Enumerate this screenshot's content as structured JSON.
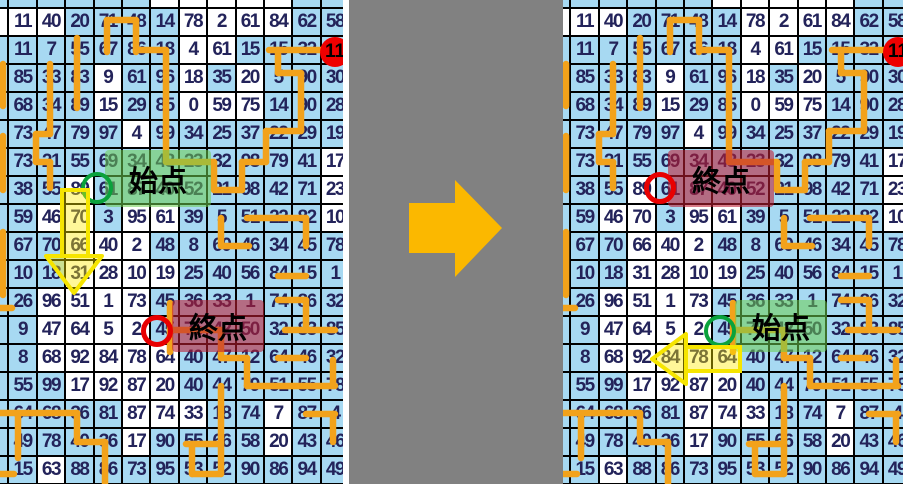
{
  "figure": {
    "description": "number-maze puzzle before/after comparison",
    "start_label": "始点",
    "end_label": "終点",
    "red_dot_value": "11"
  },
  "colors": {
    "cell_blue": "#A7D9F2",
    "cell_white": "#FFFFFF",
    "grid_border": "#000000",
    "number_text": "#23235A",
    "path_orange": "#F2A21B",
    "middle_gray": "#818181",
    "big_arrow_orange": "#FBB800",
    "start_circle_green": "#0AA23C",
    "end_circle_red": "#E80000",
    "red_dot": "#EE0000",
    "yellow_arrow_stroke": "#F6E500",
    "yellow_arrow_fill": "rgba(255,235,0,0.40)",
    "green_highlight": "rgba(110,205,80,0.55)",
    "red_highlight": "rgba(190,30,50,0.58)"
  },
  "grid": {
    "rows": 17,
    "cols": 12,
    "values": [
      [
        11,
        40,
        20,
        71,
        48,
        14,
        78,
        2,
        61,
        84,
        62,
        58
      ],
      [
        11,
        7,
        55,
        67,
        86,
        18,
        4,
        61,
        15,
        15,
        32,
        11
      ],
      [
        85,
        33,
        83,
        9,
        61,
        96,
        18,
        35,
        20,
        5,
        90,
        30
      ],
      [
        68,
        34,
        89,
        15,
        29,
        85,
        0,
        59,
        75,
        14,
        90,
        28
      ],
      [
        73,
        47,
        79,
        97,
        4,
        99,
        34,
        25,
        37,
        22,
        29,
        19
      ],
      [
        73,
        21,
        55,
        69,
        34,
        48,
        23,
        32,
        98,
        79,
        41,
        17
      ],
      [
        38,
        55,
        89,
        61,
        87,
        40,
        52,
        21,
        98,
        42,
        71,
        23
      ],
      [
        59,
        46,
        70,
        3,
        95,
        61,
        39,
        5,
        51,
        22,
        82,
        10
      ],
      [
        67,
        70,
        66,
        40,
        2,
        48,
        8,
        60,
        46,
        34,
        45,
        78
      ],
      [
        10,
        18,
        31,
        28,
        10,
        19,
        25,
        40,
        56,
        84,
        15,
        1
      ],
      [
        26,
        96,
        51,
        1,
        73,
        45,
        36,
        33,
        1,
        74,
        86,
        32
      ],
      [
        9,
        47,
        64,
        5,
        2,
        45,
        75,
        42,
        50,
        32,
        83,
        85
      ],
      [
        8,
        68,
        92,
        84,
        78,
        64,
        40,
        47,
        12,
        64,
        46,
        32
      ],
      [
        55,
        99,
        17,
        92,
        87,
        20,
        40,
        44,
        79,
        51,
        55,
        78
      ],
      [
        64,
        68,
        36,
        81,
        87,
        74,
        33,
        18,
        74,
        7,
        87,
        4
      ],
      [
        49,
        78,
        40,
        36,
        17,
        90,
        55,
        66,
        58,
        20,
        43,
        46
      ],
      [
        15,
        63,
        88,
        86,
        73,
        95,
        53,
        52,
        90,
        86,
        94,
        49
      ]
    ],
    "cell_colors": [
      "WWBBBBWWWWBB",
      "BBBBBBWWBBBB",
      "BBBWBBWBWBBB",
      "BBBWBBWWWBBB",
      "BBBBWBBBBBBB",
      "BBBBBBBBBBBW",
      "BBWBBBBBBBBW",
      "BWWBWWBBBBBW",
      "BBWWWBBBBBBB",
      "BBWWWWBBBBBB",
      "BWWWWBBBBBBB",
      "BWWWWBBBBBBB",
      "BWWWWWBBBBBB",
      "BBWWWWBBBBBB",
      "BBBBWWWBBWBB",
      "BBBBWBBBBWBB",
      "BWBBBBBBBBBB"
    ],
    "sliver_col_colors": "WBBBBBBBBBBBBBBBB",
    "sliver_row_colors": "BBBBBWWWWWBB"
  },
  "path_segments": [
    [
      107,
      52,
      107,
      20
    ],
    [
      107,
      20,
      136,
      20
    ],
    [
      136,
      20,
      136,
      52
    ],
    [
      136,
      50,
      166,
      50
    ],
    [
      166,
      50,
      166,
      162
    ],
    [
      166,
      162,
      214,
      162
    ],
    [
      214,
      162,
      214,
      190
    ],
    [
      214,
      190,
      242,
      190
    ],
    [
      242,
      190,
      242,
      162
    ],
    [
      242,
      162,
      266,
      162
    ],
    [
      266,
      162,
      266,
      131
    ],
    [
      266,
      131,
      301,
      131
    ],
    [
      301,
      131,
      301,
      73
    ],
    [
      278,
      73,
      301,
      73
    ],
    [
      278,
      50,
      278,
      73
    ],
    [
      269,
      50,
      332,
      50
    ],
    [
      77,
      38,
      77,
      108
    ],
    [
      50,
      64,
      50,
      134
    ],
    [
      36,
      134,
      50,
      134
    ],
    [
      36,
      134,
      36,
      162
    ],
    [
      36,
      162,
      50,
      162
    ],
    [
      50,
      162,
      50,
      188
    ],
    [
      3,
      64,
      3,
      106
    ],
    [
      3,
      136,
      3,
      190
    ],
    [
      3,
      232,
      3,
      295
    ],
    [
      0,
      308,
      12,
      308
    ],
    [
      221,
      218,
      221,
      246
    ],
    [
      221,
      246,
      249,
      246
    ],
    [
      247,
      218,
      306,
      218
    ],
    [
      306,
      218,
      306,
      246
    ],
    [
      278,
      276,
      306,
      276
    ],
    [
      278,
      300,
      306,
      300
    ],
    [
      306,
      300,
      306,
      330
    ],
    [
      285,
      330,
      335,
      330
    ],
    [
      170,
      303,
      170,
      352
    ],
    [
      170,
      330,
      221,
      330
    ],
    [
      221,
      330,
      221,
      358
    ],
    [
      221,
      358,
      247,
      358
    ],
    [
      247,
      358,
      247,
      386
    ],
    [
      247,
      386,
      335,
      386
    ],
    [
      221,
      386,
      221,
      474
    ],
    [
      192,
      474,
      221,
      474
    ],
    [
      192,
      446,
      192,
      474
    ],
    [
      186,
      444,
      221,
      444
    ],
    [
      278,
      358,
      306,
      358
    ],
    [
      333,
      360,
      333,
      386
    ],
    [
      306,
      414,
      335,
      414
    ],
    [
      333,
      414,
      333,
      442
    ],
    [
      0,
      413,
      77,
      413
    ],
    [
      77,
      413,
      77,
      442
    ],
    [
      77,
      442,
      105,
      442
    ],
    [
      105,
      442,
      105,
      486
    ],
    [
      18,
      417,
      18,
      458
    ],
    [
      0,
      474,
      14,
      474
    ]
  ],
  "annotation_geometry": {
    "upper_box": {
      "x": 105,
      "y": 150,
      "w": 106,
      "h": 57
    },
    "lower_box": {
      "x": 172,
      "y": 300,
      "w": 92,
      "h": 52
    },
    "upper_circle": {
      "cx": 97,
      "cy": 188,
      "r": 16
    },
    "lower_circle": {
      "cx": 157,
      "cy": 331,
      "r": 16
    },
    "red_dot": {
      "cx": 335,
      "cy": 52,
      "r": 15
    },
    "down_arrow": {
      "shaft": [
        62,
        190,
        26,
        66
      ],
      "head": [
        [
          46,
          256
        ],
        [
          102,
          256
        ],
        [
          74,
          293
        ]
      ]
    },
    "left_arrow": {
      "shaft": [
        123,
        347,
        54,
        24
      ],
      "head": [
        [
          123,
          334
        ],
        [
          123,
          384
        ],
        [
          89,
          359
        ]
      ]
    }
  },
  "panels": {
    "left": {
      "x": 0,
      "w": 343,
      "grid_dx": -20,
      "upper": "start",
      "lower": "end",
      "arrow": "down_arrow"
    },
    "right": {
      "x": 563,
      "w": 340,
      "grid_dx": -21,
      "upper": "end",
      "lower": "start",
      "arrow": "left_arrow"
    }
  },
  "layout": {
    "left_edge_strip": {
      "x": 343,
      "w": 6
    },
    "gray_band": {
      "x": 349,
      "w": 214
    },
    "right_edge_strip": {
      "x": 903,
      "w": 9
    },
    "cell_w": 28.4,
    "cell_h": 28,
    "grid_dy": -20,
    "middle_arrow_polygon": [
      [
        409,
        203
      ],
      [
        455,
        203
      ],
      [
        455,
        180
      ],
      [
        502,
        228
      ],
      [
        455,
        277
      ],
      [
        455,
        253
      ],
      [
        409,
        253
      ]
    ]
  }
}
